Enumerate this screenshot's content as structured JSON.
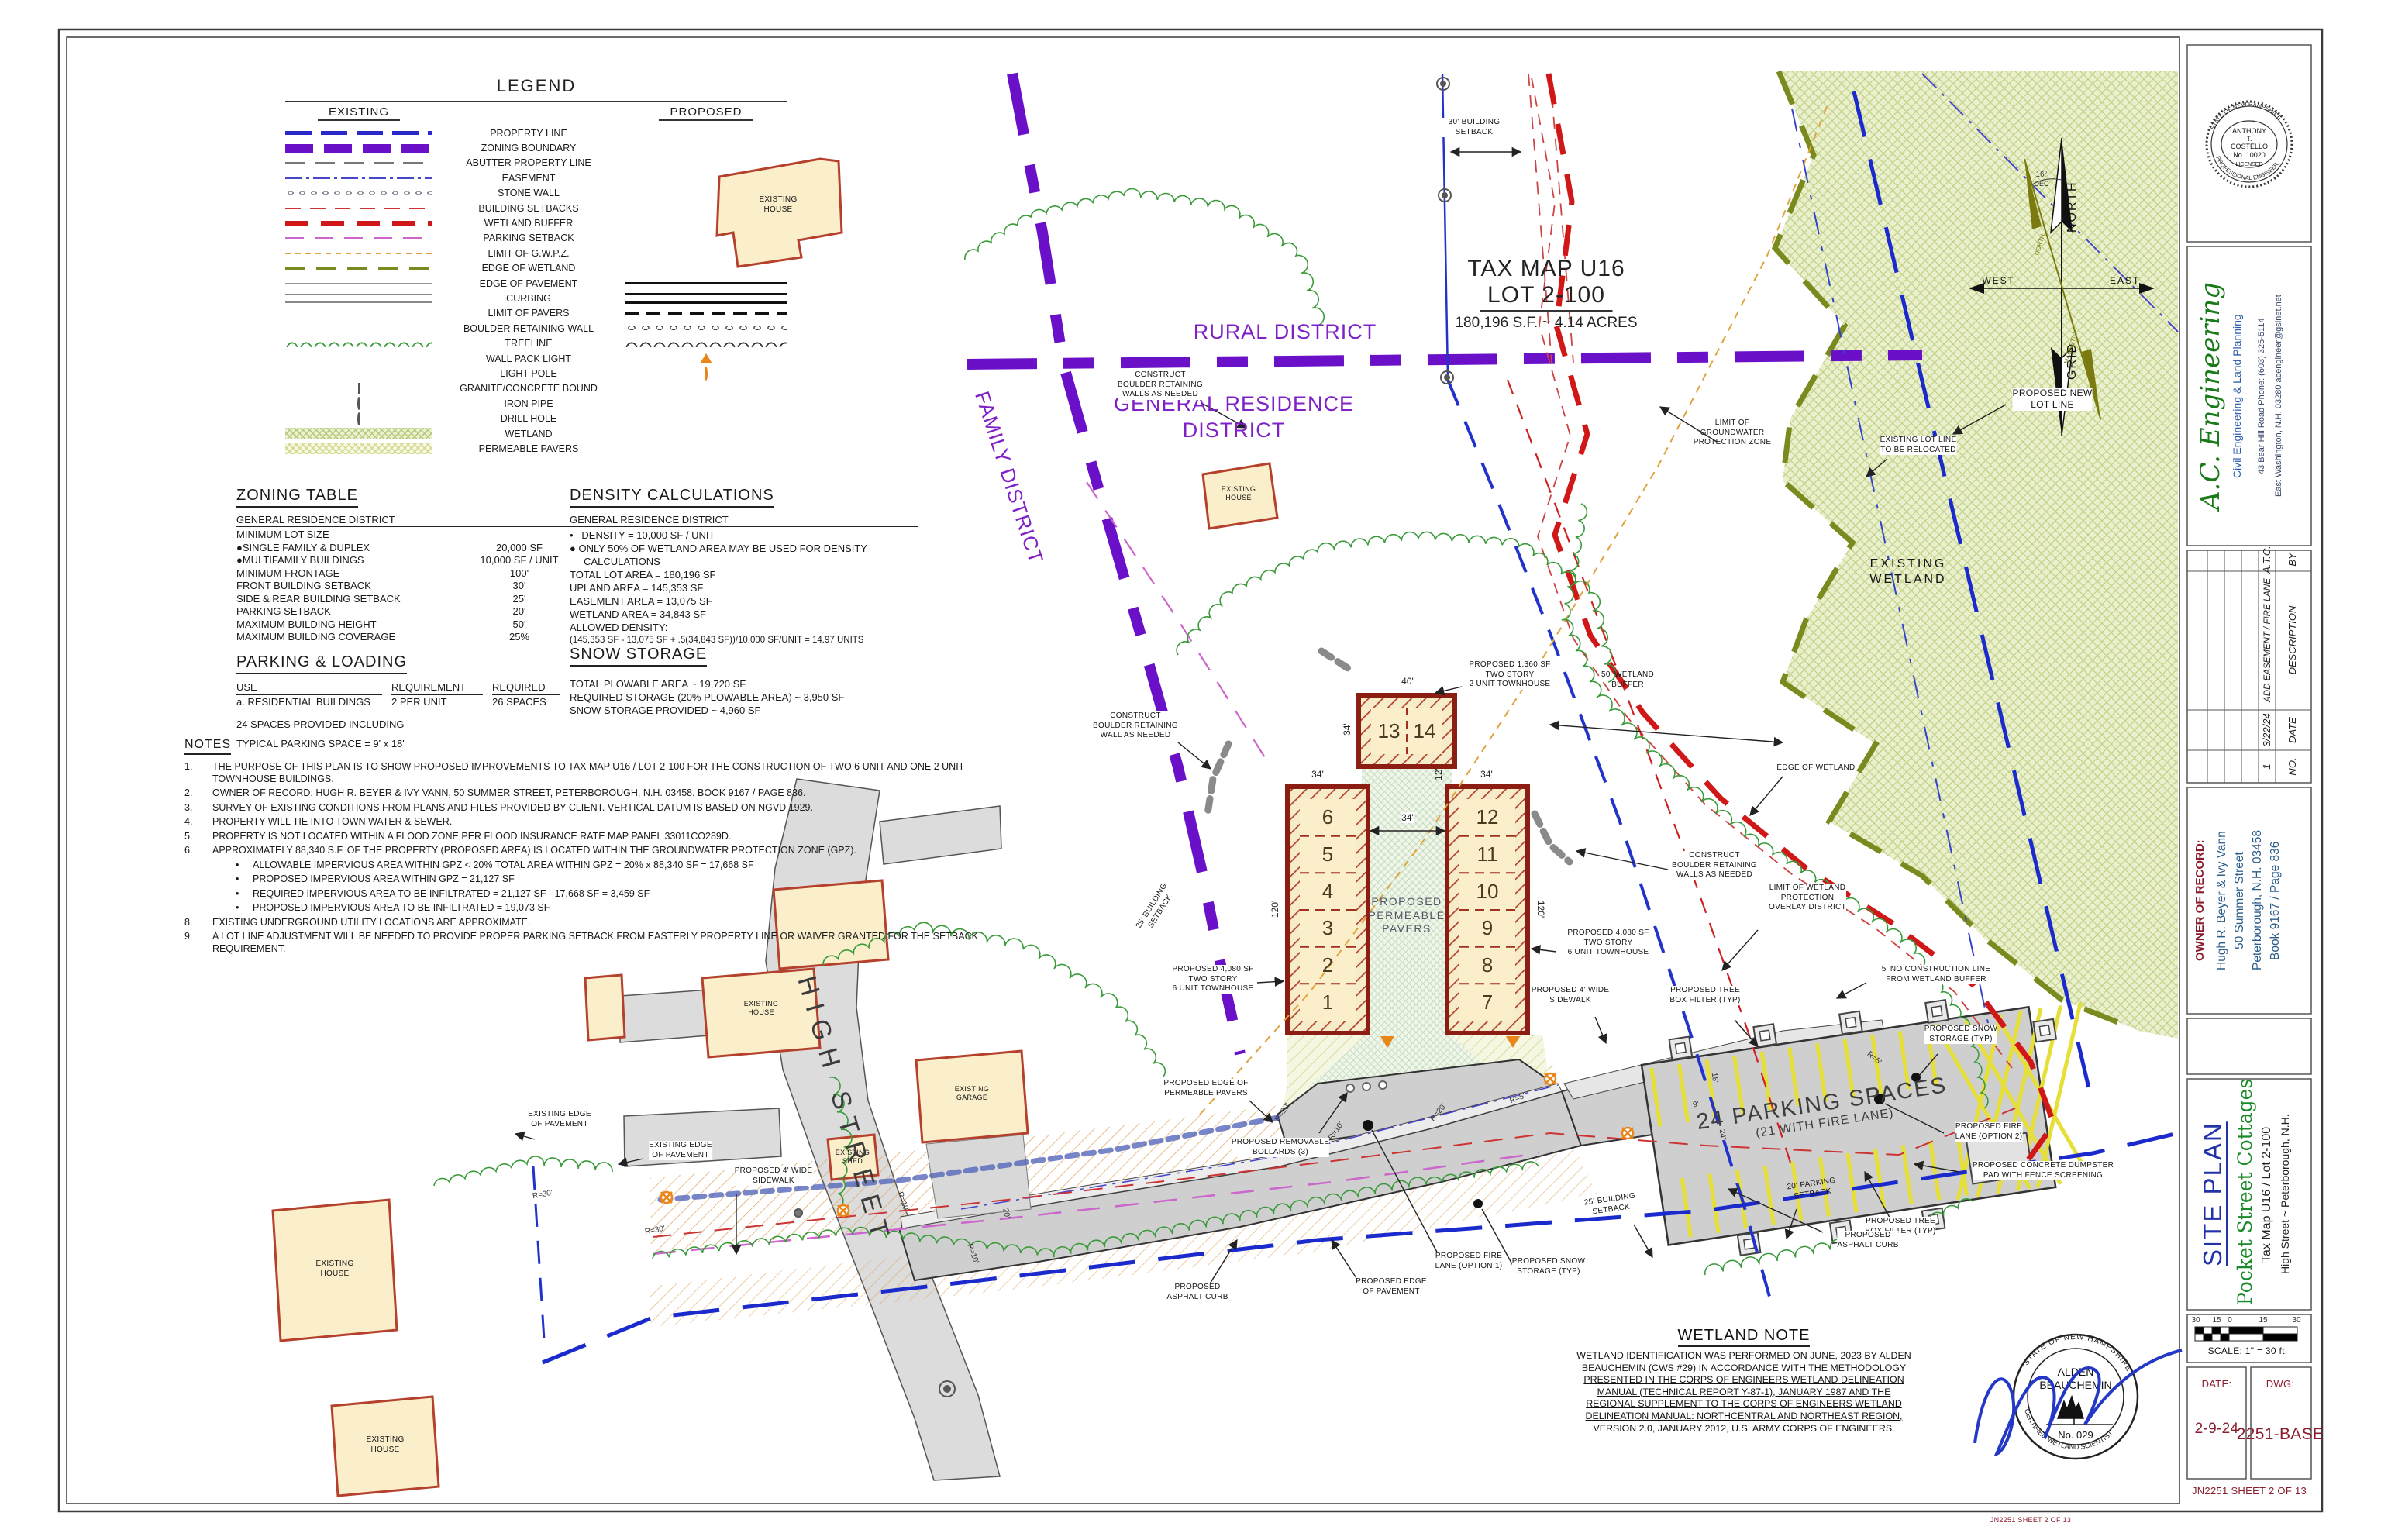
{
  "legend": {
    "title": "LEGEND",
    "col_existing": "EXISTING",
    "col_proposed": "PROPOSED",
    "items": [
      {
        "label": "PROPERTY LINE",
        "ex": "property-line",
        "pr": ""
      },
      {
        "label": "ZONING BOUNDARY",
        "ex": "zoning-boundary",
        "pr": ""
      },
      {
        "label": "ABUTTER PROPERTY LINE",
        "ex": "abutter",
        "pr": ""
      },
      {
        "label": "EASEMENT",
        "ex": "easement",
        "pr": ""
      },
      {
        "label": "STONE WALL",
        "ex": "stone-wall",
        "pr": ""
      },
      {
        "label": "BUILDING SETBACKS",
        "ex": "building-setbacks",
        "pr": ""
      },
      {
        "label": "WETLAND BUFFER",
        "ex": "wetland-buffer",
        "pr": ""
      },
      {
        "label": "PARKING SETBACK",
        "ex": "parking-setback",
        "pr": ""
      },
      {
        "label": "LIMIT OF G.W.P.Z.",
        "ex": "gwpz",
        "pr": ""
      },
      {
        "label": "EDGE OF WETLAND",
        "ex": "edge-wetland",
        "pr": ""
      },
      {
        "label": "EDGE OF PAVEMENT",
        "ex": "edge-pavement",
        "pr": "edge-pavement-p"
      },
      {
        "label": "CURBING",
        "ex": "curbing",
        "pr": "curbing-p"
      },
      {
        "label": "LIMIT OF PAVERS",
        "ex": "",
        "pr": "limit-pavers-p"
      },
      {
        "label": "BOULDER RETAINING WALL",
        "ex": "",
        "pr": "boulder-p"
      },
      {
        "label": "TREELINE",
        "ex": "treeline",
        "pr": "treeline-p"
      },
      {
        "label": "WALL PACK LIGHT",
        "ex": "",
        "pr": "wallpack-p"
      },
      {
        "label": "LIGHT POLE",
        "ex": "",
        "pr": "lightpole-p"
      },
      {
        "label": "GRANITE/CONCRETE BOUND",
        "ex": "bound",
        "pr": ""
      },
      {
        "label": "IRON PIPE",
        "ex": "iron-pipe",
        "pr": ""
      },
      {
        "label": "DRILL HOLE",
        "ex": "drill-hole",
        "pr": ""
      },
      {
        "label": "WETLAND",
        "ex": "wetland-sw",
        "pr": ""
      },
      {
        "label": "PERMEABLE PAVERS",
        "ex": "pavers-sw",
        "pr": ""
      }
    ]
  },
  "zoning": {
    "title": "ZONING TABLE",
    "district": "GENERAL RESIDENCE DISTRICT",
    "rows": [
      {
        "l": "MINIMUM LOT SIZE",
        "v": ""
      },
      {
        "l": "●SINGLE FAMILY & DUPLEX",
        "v": "20,000 SF"
      },
      {
        "l": "●MULTIFAMILY BUILDINGS",
        "v": "10,000 SF / UNIT"
      },
      {
        "l": "MINIMUM FRONTAGE",
        "v": "100'"
      },
      {
        "l": "FRONT BUILDING SETBACK",
        "v": "30'"
      },
      {
        "l": "SIDE & REAR BUILDING SETBACK",
        "v": "25'"
      },
      {
        "l": "PARKING SETBACK",
        "v": "20'"
      },
      {
        "l": "MAXIMUM BUILDING HEIGHT",
        "v": "50'"
      },
      {
        "l": "MAXIMUM BUILDING COVERAGE",
        "v": "25%"
      }
    ]
  },
  "density": {
    "title": "DENSITY CALCULATIONS",
    "district": "GENERAL RESIDENCE DISTRICT",
    "lines": [
      {
        "t": "•   DENSITY = 10,000 SF / UNIT",
        "s": "0"
      },
      {
        "t": "● ONLY 50% OF WETLAND AREA MAY BE USED FOR DENSITY",
        "s": "0"
      },
      {
        "t": "     CALCULATIONS",
        "s": "0"
      },
      {
        "t": "TOTAL LOT AREA = 180,196 SF",
        "s": "0"
      },
      {
        "t": "UPLAND AREA = 145,353 SF",
        "s": "0"
      },
      {
        "t": "EASEMENT AREA = 13,075 SF",
        "s": "0"
      },
      {
        "t": "WETLAND AREA = 34,843 SF",
        "s": "0"
      },
      {
        "t": "ALLOWED DENSITY:",
        "s": "0"
      },
      {
        "t": "(145,353 SF - 13,075 SF + .5(34,843 SF))/10,000 SF/UNIT = 14.97 UNITS",
        "s": "1"
      }
    ]
  },
  "parking_loading": {
    "title": "PARKING & LOADING",
    "h_use": "USE",
    "h_req": "REQUIREMENT",
    "h_reqd": "REQUIRED",
    "row_use": "a. RESIDENTIAL BUILDINGS",
    "row_req": "2 PER UNIT",
    "row_reqd": "26 SPACES",
    "extra1": "24 SPACES PROVIDED INCLUDING",
    "extra2": "TYPICAL PARKING SPACE = 9' x 18'"
  },
  "snow": {
    "title": "SNOW STORAGE",
    "lines": [
      {
        "t": "TOTAL PLOWABLE AREA ~ 19,720 SF"
      },
      {
        "t": "REQUIRED STORAGE (20% PLOWABLE AREA) ~ 3,950 SF"
      },
      {
        "t": "SNOW STORAGE PROVIDED ~ 4,960 SF"
      }
    ]
  },
  "notes": {
    "title": "NOTES",
    "items": [
      {
        "n": "1.",
        "t": "THE PURPOSE OF THIS PLAN IS TO SHOW PROPOSED IMPROVEMENTS TO TAX MAP U16 / LOT 2-100 FOR THE CONSTRUCTION OF TWO 6 UNIT AND ONE 2 UNIT TOWNHOUSE BUILDINGS.",
        "s": "0"
      },
      {
        "n": "2.",
        "t": "OWNER OF RECORD: HUGH R. BEYER & IVY VANN, 50 SUMMER STREET, PETERBOROUGH, N.H. 03458. BOOK 9167 / PAGE 836.",
        "s": "0"
      },
      {
        "n": "3.",
        "t": "SURVEY OF EXISTING CONDITIONS FROM PLANS AND FILES PROVIDED BY CLIENT. VERTICAL DATUM IS BASED ON NGVD 1929.",
        "s": "0"
      },
      {
        "n": "4.",
        "t": "PROPERTY WILL TIE INTO TOWN WATER & SEWER.",
        "s": "0"
      },
      {
        "n": "5.",
        "t": "PROPERTY IS NOT LOCATED WITHIN A FLOOD ZONE PER FLOOD INSURANCE RATE MAP PANEL 33011CO289D.",
        "s": "0"
      },
      {
        "n": "6.",
        "t": "APPROXIMATELY 88,340 S.F. OF THE PROPERTY (PROPOSED AREA) IS LOCATED WITHIN THE GROUNDWATER PROTECTION ZONE (GPZ).",
        "s": "0"
      },
      {
        "n": "•",
        "t": "ALLOWABLE IMPERVIOUS AREA WITHIN GPZ < 20% TOTAL AREA WITHIN GPZ = 20% x 88,340 SF = 17,668 SF",
        "s": "1"
      },
      {
        "n": "•",
        "t": "PROPOSED IMPERVIOUS AREA WITHIN GPZ = 21,127 SF",
        "s": "1"
      },
      {
        "n": "•",
        "t": "REQUIRED IMPERVIOUS AREA TO BE INFILTRATED = 21,127 SF - 17,668 SF = 3,459 SF",
        "s": "1"
      },
      {
        "n": "•",
        "t": "PROPOSED IMPERVIOUS AREA TO BE INFILTRATED = 19,073 SF",
        "s": "1"
      },
      {
        "n": "8.",
        "t": "EXISTING UNDERGROUND UTILITY LOCATIONS ARE APPROXIMATE.",
        "s": "0"
      },
      {
        "n": "9.",
        "t": "A LOT LINE ADJUSTMENT WILL BE NEEDED TO PROVIDE PROPER PARKING SETBACK FROM EASTERLY PROPERTY LINE OR WAIVER GRANTED FOR THE SETBACK REQUIREMENT.",
        "s": "0"
      }
    ]
  },
  "wetland_note": {
    "title": "WETLAND NOTE",
    "lines": [
      {
        "t": "WETLAND IDENTIFICATION WAS PERFORMED ON JUNE, 2023 BY ALDEN",
        "u": "0"
      },
      {
        "t": "BEAUCHEMIN (CWS #29) IN ACCORDANCE WITH THE METHODOLOGY",
        "u": "0"
      },
      {
        "t": "PRESENTED IN THE CORPS OF ENGINEERS WETLAND DELINEATION",
        "u": "1"
      },
      {
        "t": "MANUAL (TECHNICAL REPORT Y-87-1), JANUARY 1987 AND THE",
        "u": "1"
      },
      {
        "t": "REGIONAL SUPPLEMENT TO THE CORPS OF ENGINEERS WETLAND",
        "u": "1"
      },
      {
        "t": "DELINEATION MANUAL: NORTHCENTRAL AND NORTHEAST REGION,",
        "u": "1"
      },
      {
        "t": "VERSION 2.0, JANUARY 2012, U.S. ARMY CORPS OF ENGINEERS.",
        "u": "0"
      }
    ]
  },
  "districts": {
    "rural": "RURAL DISTRICT",
    "general": "GENERAL RESIDENCE\nDISTRICT",
    "family": "FAMILY DISTRICT"
  },
  "parcel": {
    "l1": "TAX MAP U16",
    "l2": "LOT 2-100",
    "l3": "180,196 S.F. ~ 4.14 ACRES"
  },
  "labels": {
    "setback30": "30'  BUILDING\nSETBACK",
    "gwpz": "LIMIT  OF\nGROUNDWATER\nPROTECTION  ZONE",
    "buffer50": "50'  WETLAND\nBUFFER",
    "exwetland": "EXISTING\nWETLAND",
    "exlotline": "EXISTING  LOT  LINE\nTO  BE  RELOCATED",
    "newlotline": "PROPOSED NEW\nLOT LINE",
    "edgewetland": "EDGE  OF  WETLAND",
    "boulder_a": "CONSTRUCT\nBOULDER RETAINING\nWALLS AS NEEDED",
    "boulder_b": "CONSTRUCT\nBOULDER RETAINING\nWALL AS NEEDED",
    "boulder_c": "CONSTRUCT\nBOULDER RETAINING\nWALLS AS NEEDED",
    "overlay": "LIMIT  OF  WETLAND\nPROTECTION\nOVERLAY  DISTRICT",
    "nocon5": "5'  NO  CONSTRUCTION  LINE\nFROM  WETLAND  BUFFER",
    "treebox": "PROPOSED TREE\nBOX FILTER (TYP)",
    "snowstorage": "PROPOSED SNOW\nSTORAGE (TYP)",
    "fire2": "PROPOSED FIRE\nLANE (OPTION 2)",
    "fire1": "PROPOSED FIRE\nLANE (OPTION 1)",
    "dumpster": "PROPOSED CONCRETE DUMPSTER\nPAD WITH FENCE SCREENING",
    "psetback20": "20'  PARKING\nSETBACK",
    "bsetback25": "25'  BUILDING\nSETBACK",
    "asphalt": "PROPOSED\nASPHALT CURB",
    "pedge": "PROPOSED EDGE\nOF PAVEMENT",
    "ppedge": "PROPOSED EDGE OF\nPERMEABLE PAVERS",
    "bollards": "PROPOSED REMOVABLE\nBOLLARDS (3)",
    "sidewalk4": "PROPOSED 4' WIDE\nSIDEWALK",
    "t2unit": "PROPOSED 1,360 SF\nTWO STORY\n2 UNIT TOWNHOUSE",
    "t6unit": "PROPOSED 4,080 SF\nTWO STORY\n6 UNIT TOWNHOUSE",
    "pavers": "PROPOSED\nPERMEABLE\nPAVERS",
    "exedge": "EXISTING  EDGE\nOF  PAVEMENT",
    "exhouse": "EXISTING\nHOUSE",
    "exgarage": "EXISTING\nGARAGE",
    "exshed": "EXISTING\nSHED",
    "highstreet": "HIGH STREET",
    "parking24a": "24 PARKING SPACES",
    "parking24b": "(21 WITH FIRE LANE)"
  },
  "dims": {
    "d40": "40'",
    "d34": "34'",
    "d12": "12'",
    "d120": "120'",
    "d18": "18'",
    "d9": "9'",
    "d24": "24'",
    "d20": "20'",
    "r30": "R=30'",
    "r20": "R=20'",
    "r10": "R=10'",
    "r5": "R=5'"
  },
  "buildings": {
    "a": {
      "units": [
        {
          "n": "6"
        },
        {
          "n": "5"
        },
        {
          "n": "4"
        },
        {
          "n": "3"
        },
        {
          "n": "2"
        },
        {
          "n": "1"
        }
      ]
    },
    "b": {
      "units": [
        {
          "n": "12"
        },
        {
          "n": "11"
        },
        {
          "n": "10"
        },
        {
          "n": "9"
        },
        {
          "n": "8"
        },
        {
          "n": "7"
        }
      ]
    },
    "c": {
      "units": [
        {
          "n": "13"
        },
        {
          "n": "14"
        }
      ]
    }
  },
  "compass": {
    "north": "NORTH",
    "grid": "GRID",
    "west": "WEST",
    "east": "EAST",
    "dec": "16°",
    "dec2": "DEC",
    "mag": "MAGNETIC",
    "magn": "NORTH"
  },
  "stamps": {
    "pe": {
      "l1": "ANTHONY",
      "l2": "T.",
      "l3": "COSTELLO",
      "l4": "No. 10020",
      "l5": "LICENSED",
      "ring_top": "STATE OF NEW HAMPSHIRE",
      "ring_bottom": "PROFESSIONAL ENGINEER"
    },
    "wet": {
      "n1": "ALDEN",
      "n2": "BEAUCHEMIN",
      "no": "No. 029",
      "ring_top": "STATE OF NEW HAMPSHIRE",
      "ring_bottom": "CERTIFIED WETLAND SCIENTIST"
    }
  },
  "titleblock": {
    "company": {
      "name": "A.C. Engineering",
      "tag": "Civil Engineering & Land Planning",
      "addr1": "43 Bear Hill Road    Phone: (603) 325-5114",
      "addr2": "East Washington, N.H. 03280    acengineer@gsinet.net"
    },
    "revisions": {
      "no": "NO.",
      "date": "DATE",
      "desc": "DESCRIPTION",
      "by": "BY",
      "r_no": "1",
      "r_date": "3/22/24",
      "r_desc": "ADD EASEMENT / FIRE LANE",
      "r_by": "A.T.C."
    },
    "owner": {
      "heading": "OWNER OF RECORD:",
      "lines": [
        {
          "t": "Hugh R. Beyer & Ivy Vann"
        },
        {
          "t": "50 Summer Street"
        },
        {
          "t": "Peterborough, N.H. 03458"
        },
        {
          "t": "Book 9167 / Page 836"
        }
      ]
    },
    "title": {
      "t1": "SITE PLAN",
      "t2": "Pocket Street Cottages",
      "t3": "Tax Map U16 / Lot 2-100",
      "t4": "High Street ~ Peterborough, N.H."
    },
    "scale": {
      "m1": "30",
      "m2": "15",
      "m3": "0",
      "m4": "15",
      "m5": "30",
      "label": "SCALE:  1\" =  30  ft."
    },
    "date_label": "DATE:",
    "date_value": "2-9-24",
    "dwg_label": "DWG:",
    "dwg_value": "2251-BASE",
    "footer": "JN2251      SHEET 2 OF 13"
  },
  "footer_tiny": "JN2251    SHEET 2 OF 13"
}
